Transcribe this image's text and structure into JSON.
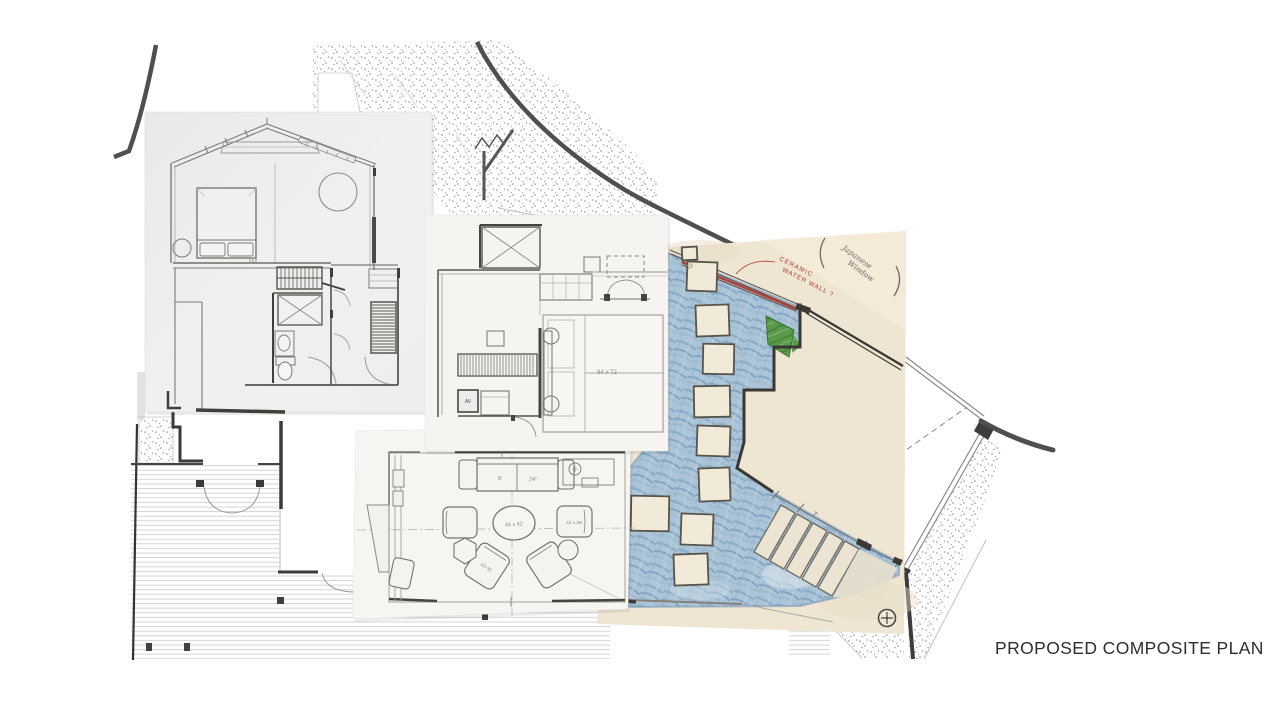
{
  "page": {
    "title": "PROPOSED COMPOSITE PLAN"
  },
  "colors": {
    "courtyard_blue": "#abc4d7",
    "planting_green": "#5a9a4b",
    "water_wall_red": "#b0372c",
    "plan_paper": "#efe5d3",
    "photo_paper": "#ededeb",
    "wall_dark": "#3b3833"
  },
  "colored_plan": {
    "annotations": {
      "water_wall_line1": "CERAMIC",
      "water_wall_line2": "WATER WALL ?",
      "window_note_open_paren": "(",
      "window_note_line1": "Japanese",
      "window_note_line2": "Window",
      "window_note_close_paren": ")",
      "stair_dim": "7'",
      "pencil_number": "18"
    }
  },
  "bedroom_sketch": {
    "bed_dim": "84 x 72",
    "av_label": "AV"
  },
  "living_room_sketch": {
    "sofa_dim_1": "8'",
    "sofa_dim_2": "24\"",
    "table_dim": "44 x 42",
    "chair_right_dim": "42 x 36",
    "chair_lower_dim": "42+36"
  }
}
